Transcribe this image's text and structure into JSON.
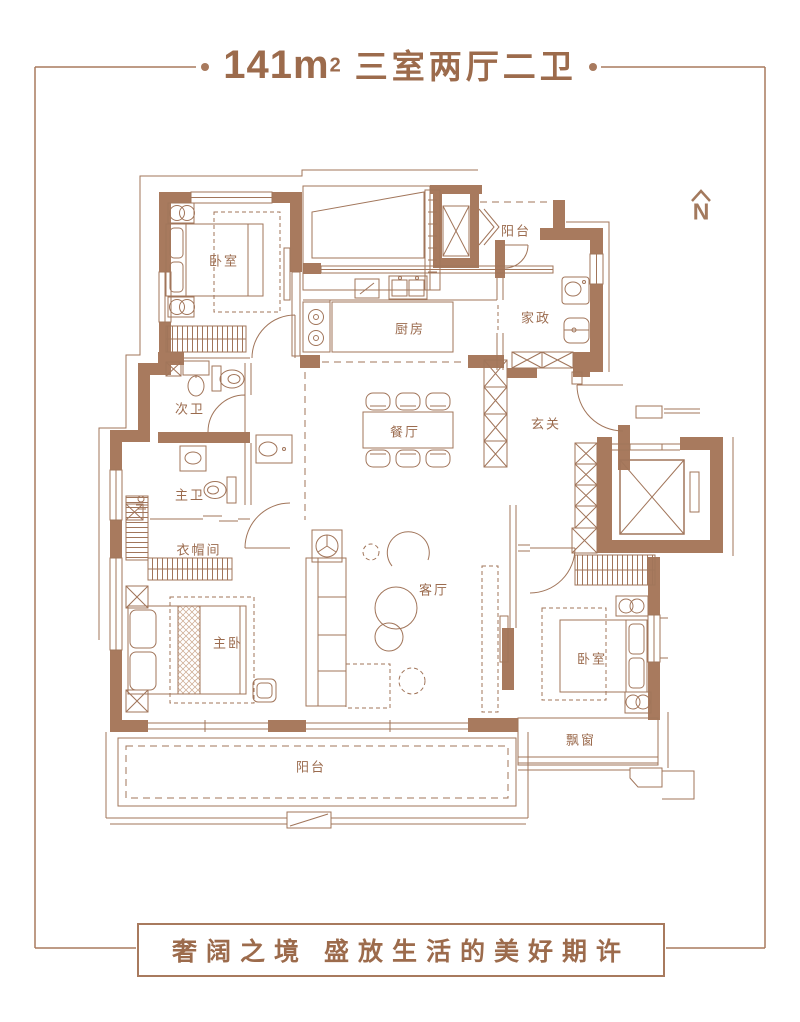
{
  "header": {
    "area_value": "141m",
    "area_sup": "2",
    "layout_type": "三室两厅二卫"
  },
  "compass": {
    "north_label": "N"
  },
  "rooms": [
    {
      "id": "bedroom-top-left",
      "label": "卧室"
    },
    {
      "id": "balcony-top",
      "label": "阳台"
    },
    {
      "id": "kitchen",
      "label": "厨房"
    },
    {
      "id": "laundry",
      "label": "家政"
    },
    {
      "id": "guest-bath",
      "label": "次卫"
    },
    {
      "id": "dining",
      "label": "餐厅"
    },
    {
      "id": "foyer",
      "label": "玄关"
    },
    {
      "id": "master-bath",
      "label": "主卫"
    },
    {
      "id": "closet",
      "label": "衣帽间"
    },
    {
      "id": "living",
      "label": "客厅"
    },
    {
      "id": "master-bedroom",
      "label": "主卧"
    },
    {
      "id": "bedroom-right",
      "label": "卧室"
    },
    {
      "id": "bay-window",
      "label": "飘窗"
    },
    {
      "id": "balcony-bottom",
      "label": "阳台"
    }
  ],
  "footer": {
    "tagline": "奢阔之境 盛放生活的美好期许"
  },
  "colors": {
    "accent": "#9C6B4C",
    "wall": "#A87A5E",
    "line": "#A1755A"
  }
}
